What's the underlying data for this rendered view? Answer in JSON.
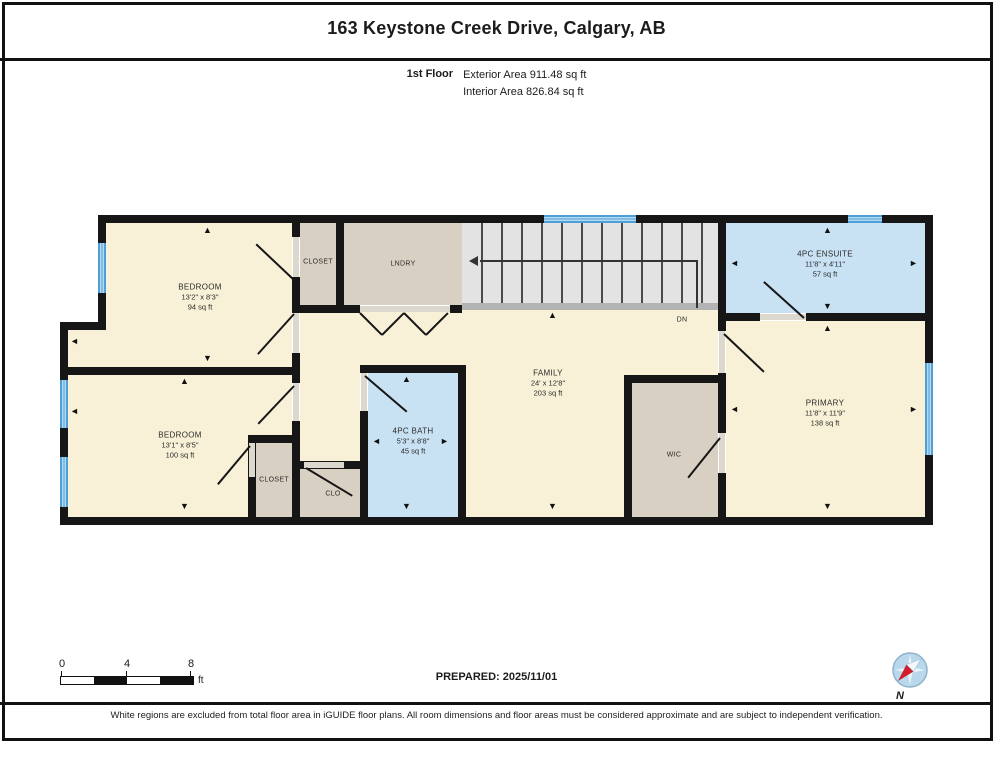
{
  "header": {
    "title": "163 Keystone Creek Drive, Calgary, AB",
    "floor_label": "1st Floor",
    "exterior_area": "Exterior Area 911.48 sq ft",
    "interior_area": "Interior Area 826.84 sq ft"
  },
  "rooms": {
    "bedroom1": {
      "name": "BEDROOM",
      "dims": "13'2\" x 8'3\"",
      "area": "94 sq ft"
    },
    "closet1": {
      "name": "CLOSET"
    },
    "laundry": {
      "name": "LNDRY"
    },
    "ensuite": {
      "name": "4PC ENSUITE",
      "dims": "11'8\" x 4'11\"",
      "area": "57 sq ft"
    },
    "family": {
      "name": "FAMILY",
      "dims": "24' x 12'8\"",
      "area": "203 sq ft"
    },
    "bedroom2": {
      "name": "BEDROOM",
      "dims": "13'1\" x 8'5\"",
      "area": "100 sq ft"
    },
    "closet2": {
      "name": "CLOSET"
    },
    "clo": {
      "name": "CLO"
    },
    "bath": {
      "name": "4PC BATH",
      "dims": "5'3\" x 8'8\"",
      "area": "45 sq ft"
    },
    "wic": {
      "name": "WIC"
    },
    "primary": {
      "name": "PRIMARY",
      "dims": "11'8\" x 11'9\"",
      "area": "138 sq ft"
    }
  },
  "stairs": {
    "down_label": "DN"
  },
  "scale_bar": {
    "ticks": [
      "0",
      "4",
      "8"
    ],
    "unit": "ft"
  },
  "footer": {
    "prepared_label": "PREPARED: 2025/11/01",
    "compass_north_label": "N",
    "disclaimer": "White regions are excluded from total floor area in iGUIDE floor plans. All room dimensions and floor areas must be considered approximate and are subject to independent verification."
  },
  "colors": {
    "room_floor": "#f8f1d7",
    "closet_floor": "#d8d0c2",
    "bath_floor": "#c8e2f4",
    "window_blue": "#4da0d7",
    "stairs_gray": "#e3e3e3",
    "wall_black": "#161616",
    "compass_red": "#cf1d2a"
  },
  "icons": {
    "compass": "compass-rose-icon",
    "stairs_direction": "left-arrow-icon"
  }
}
